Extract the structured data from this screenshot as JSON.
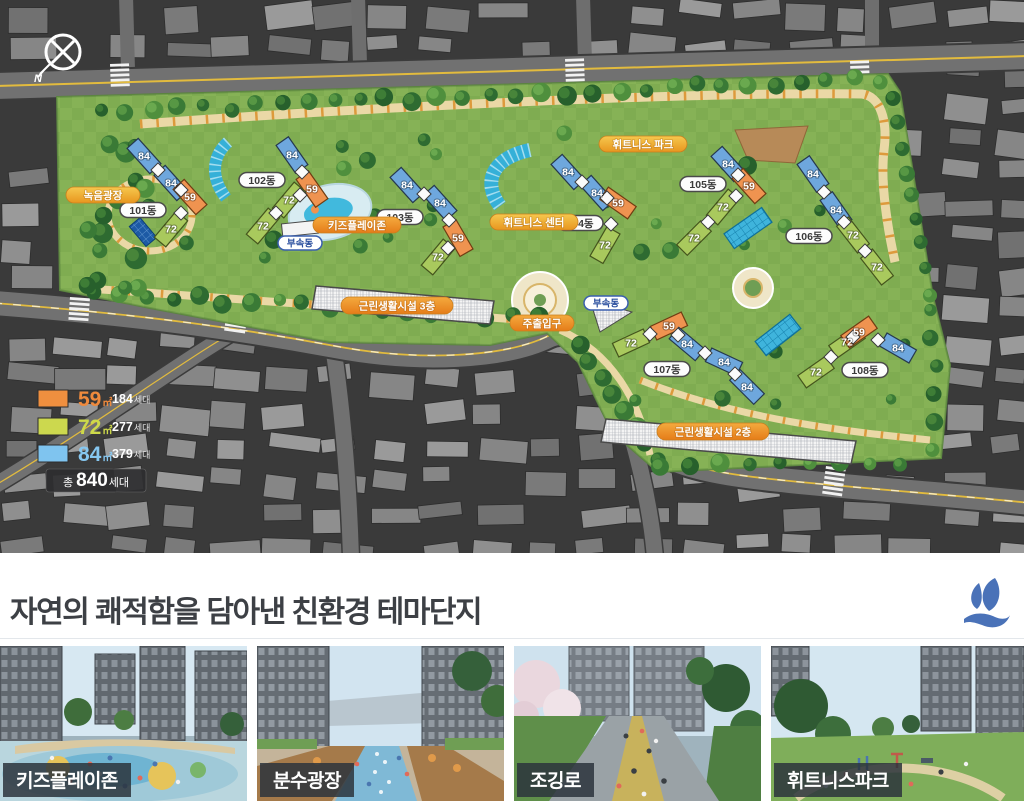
{
  "site_plan": {
    "compass_label": "N",
    "legend": {
      "items": [
        {
          "size": "59",
          "size_unit": "㎡",
          "count": "184",
          "count_unit": "세대",
          "color": "#ef8f3f",
          "text_color": "#f08a3c"
        },
        {
          "size": "72",
          "size_unit": "㎡",
          "count": "277",
          "count_unit": "세대",
          "color": "#ccd84e",
          "text_color": "#cdd94a"
        },
        {
          "size": "84",
          "size_unit": "㎡",
          "count": "379",
          "count_unit": "세대",
          "color": "#7fc4ef",
          "text_color": "#86c7f0"
        }
      ],
      "total_prefix": "총",
      "total_value": "840",
      "total_unit": "세대"
    },
    "buildings": [
      {
        "label": "101동",
        "units": [
          "84",
          "84",
          "59",
          "72"
        ]
      },
      {
        "label": "102동",
        "units": [
          "84",
          "59",
          "72",
          "72"
        ]
      },
      {
        "label": "103동",
        "units": [
          "84",
          "84",
          "59",
          "72"
        ]
      },
      {
        "label": "104동",
        "units": [
          "84",
          "84",
          "59",
          "72"
        ]
      },
      {
        "label": "105동",
        "units": [
          "84",
          "59",
          "72",
          "72"
        ]
      },
      {
        "label": "106동",
        "units": [
          "84",
          "84",
          "72",
          "72"
        ]
      },
      {
        "label": "107동",
        "units": [
          "72",
          "59",
          "84",
          "84",
          "84"
        ]
      },
      {
        "label": "108동",
        "units": [
          "72",
          "72",
          "59",
          "84"
        ]
      }
    ],
    "amenities": {
      "green_plaza": "녹음광장",
      "kids_play_zone": "키즈플레이존",
      "fitness_center": "휘트니스 센터",
      "fitness_park": "휘트니스 파크",
      "retail_3f": "근린생활시설 3층",
      "retail_2f": "근린생활시설 2층",
      "main_entrance": "주출입구",
      "annex_1": "부속동",
      "annex_2": "부속동"
    }
  },
  "section": {
    "title": "자연의 쾌적함을 담아낸 친환경 테마단지",
    "logo_color": "#4a72b8"
  },
  "thumbnails": [
    {
      "label": "키즈플레이존"
    },
    {
      "label": "분수광장"
    },
    {
      "label": "조깅로"
    },
    {
      "label": "휘트니스파크"
    }
  ]
}
